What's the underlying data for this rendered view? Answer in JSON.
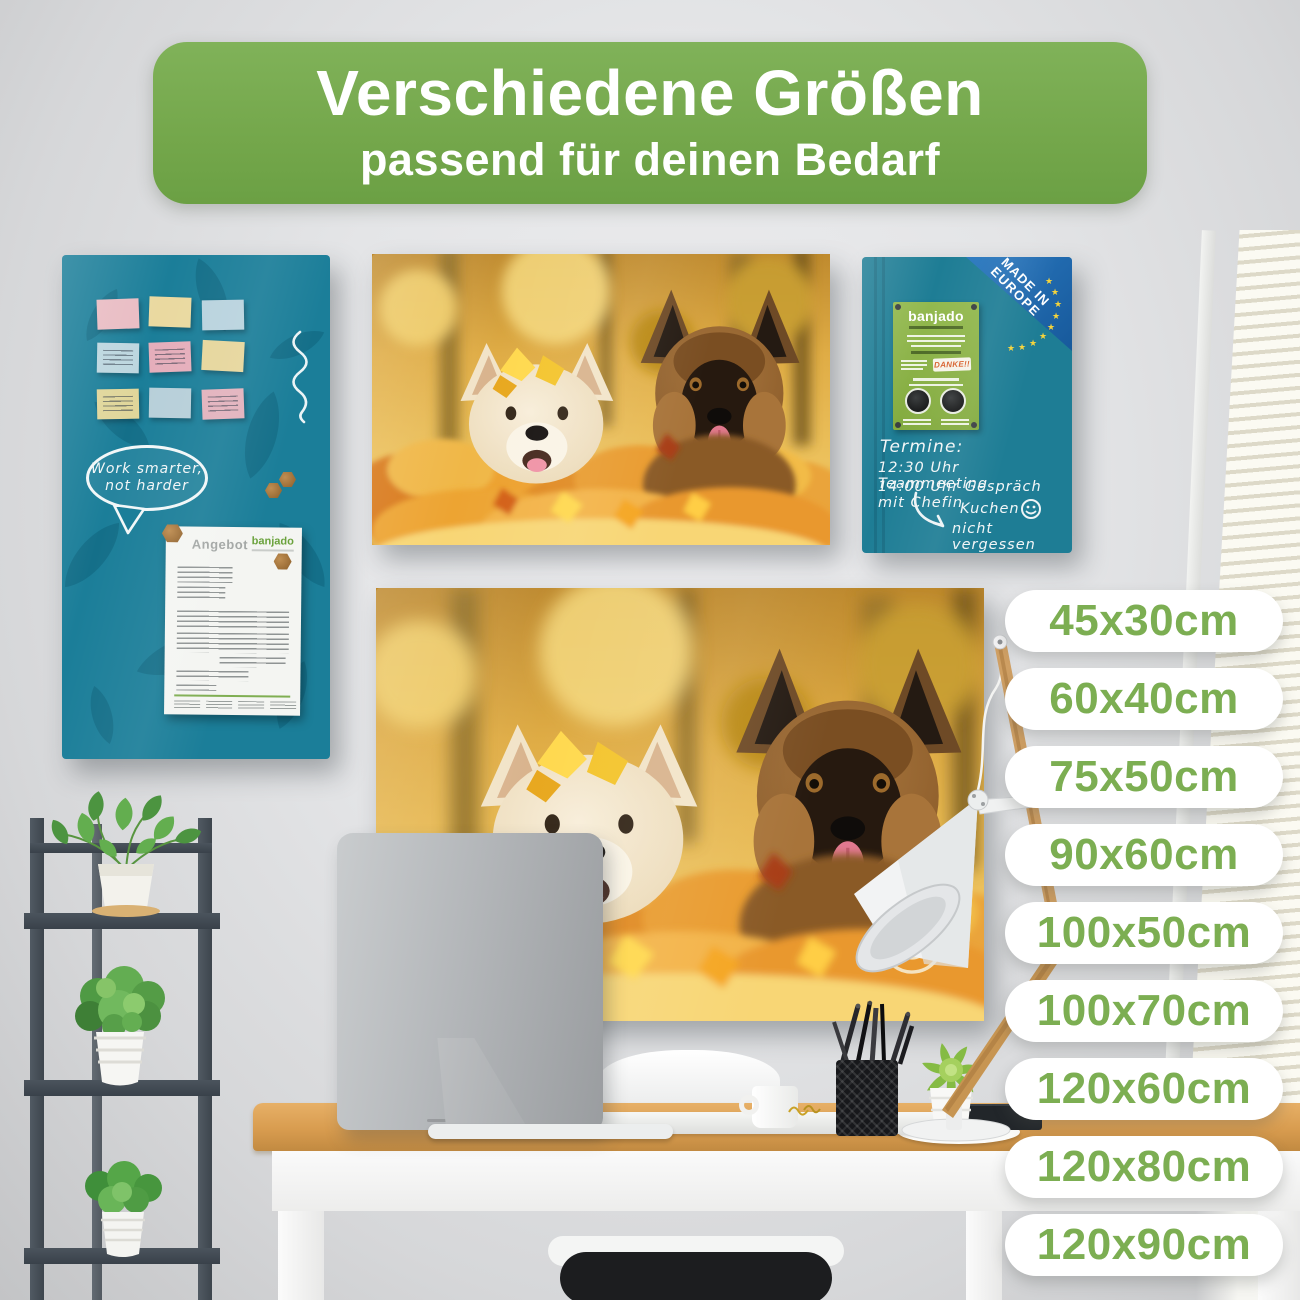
{
  "header": {
    "title": "Verschiedene Größen",
    "subtitle": "passend für deinen Bedarf"
  },
  "size_labels": [
    "45x30cm",
    "60x40cm",
    "75x50cm",
    "90x60cm",
    "100x50cm",
    "100x70cm",
    "120x60cm",
    "120x80cm",
    "120x90cm"
  ],
  "memo_board": {
    "speech_bubble": {
      "line1": "Work smarter,",
      "line2": "not harder"
    },
    "document": {
      "title": "Angebot",
      "brand": "banjado"
    }
  },
  "schedule_board": {
    "ribbon": {
      "line1": "MADE IN",
      "line2": "EUROPE"
    },
    "flyer": {
      "brand": "banjado",
      "stamp": "DANKE!!"
    },
    "handwriting": {
      "heading": "Termine:",
      "line1": "12:30 Uhr Teammeeting",
      "line2": "14:00 Uhr Gespräch mit Chefin",
      "note_line1": "Kuchen",
      "note_line2": "nicht vergessen"
    }
  },
  "icons": {
    "eu_star": "★"
  },
  "colors": {
    "header_green": "#74a74b",
    "label_green": "#7cae52",
    "board_teal": "#1b7e99",
    "ribbon_blue": "#1e6cb3",
    "flyer_green": "#8cb148",
    "desk_wood": "#d89c4f"
  }
}
